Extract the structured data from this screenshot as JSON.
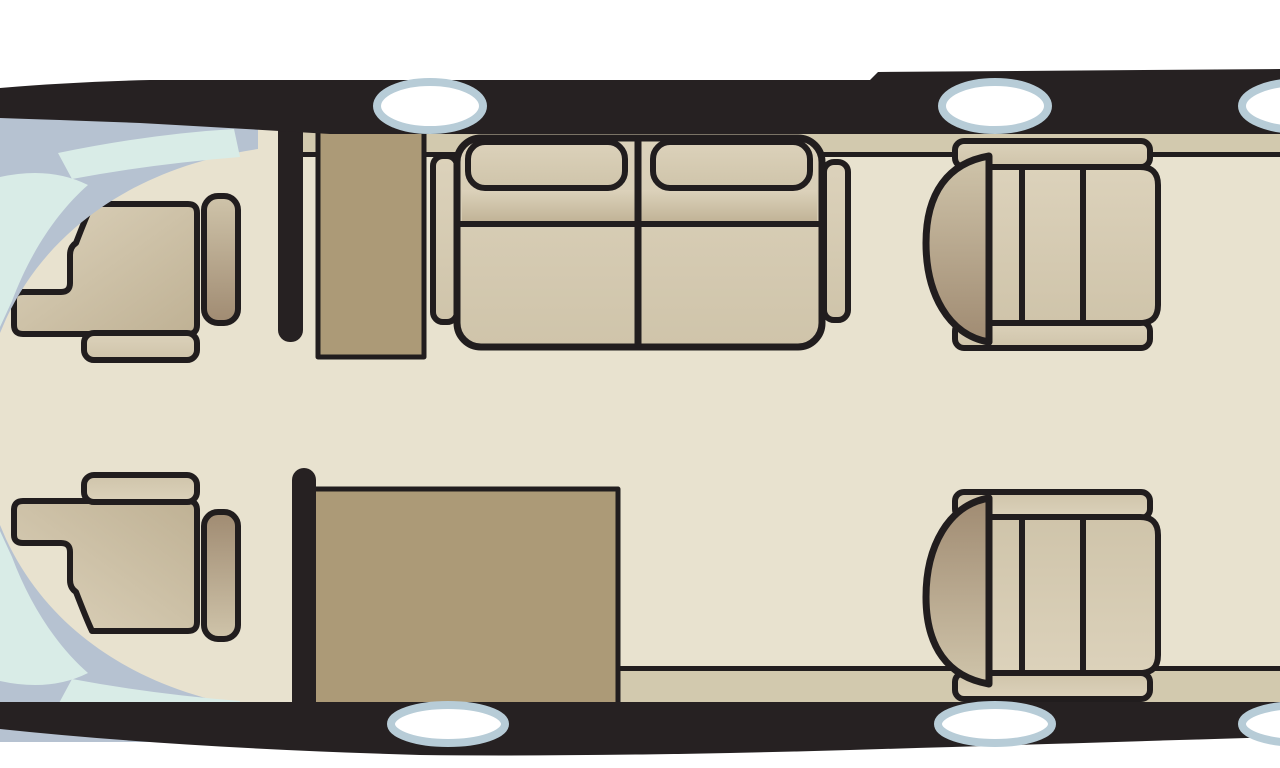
{
  "palette": {
    "background": "#ffffff",
    "fuselage_black": "#262122",
    "outline_black": "#211d1e",
    "floor_cream": "#e8e2cf",
    "ledge_tan": "#d2c9ae",
    "cabinet_tan": "#ac9a77",
    "seat_light": "#dcd2bb",
    "seat_midlight": "#cfc4aa",
    "seat_mid": "#bfb194",
    "seat_dark": "#a08b72",
    "window_ring": "#b7ccd7",
    "window_white": "#ffffff",
    "windshield_frame": "#b6c2d1",
    "windshield_glass": "#d9ece7"
  },
  "components": {
    "diagram": "Aircraft cabin floor plan",
    "windshield": "Cockpit windshield",
    "pilot_seat": "Pilot seat",
    "divan": "Two-place divan",
    "club_seat": "Club seat",
    "galley_cabinet": "Galley cabinet",
    "sidewall_cabinet": "Cabinet table",
    "bulkhead": "Bulkhead partition",
    "window": "Cabin window",
    "ledge": "Sidewall ledge"
  },
  "structure": {
    "windows_top": 3,
    "windows_bottom": 3,
    "pilot_seats": 2,
    "club_seats": 2,
    "divan_places": 2,
    "cabinets": 2
  }
}
